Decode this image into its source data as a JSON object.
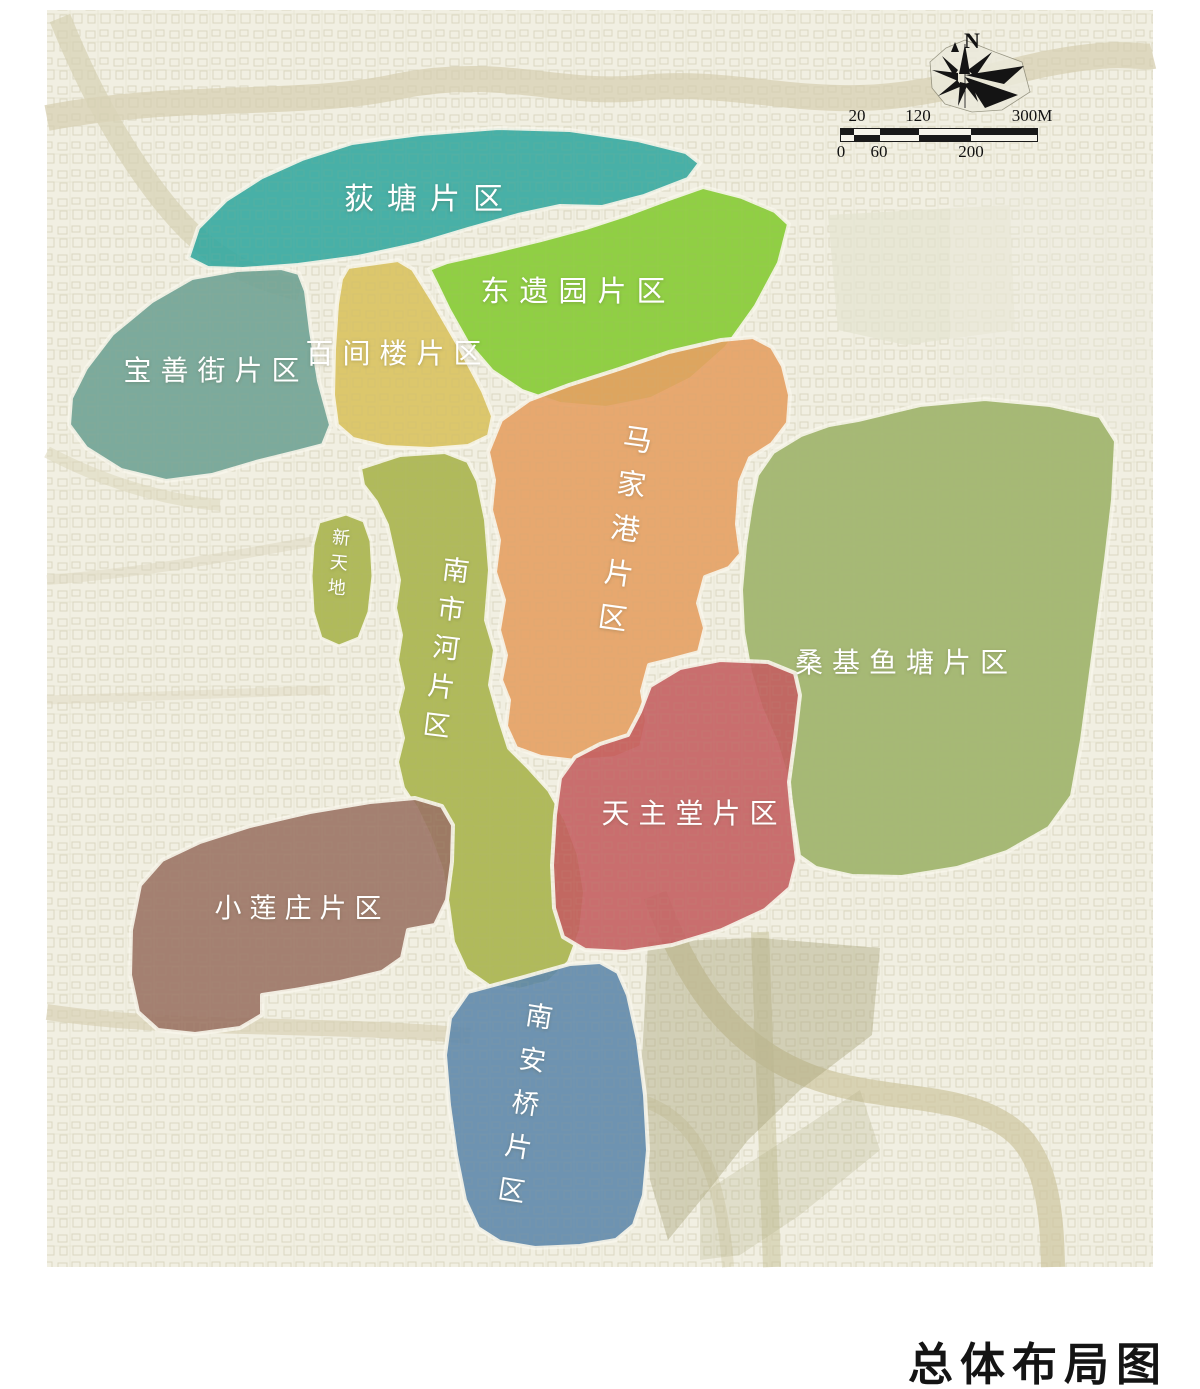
{
  "map": {
    "title": "总体布局图",
    "label_color": "#ffffff",
    "compass": {
      "north_label": "N"
    },
    "scale_bar": {
      "top_labels": [
        "20",
        "120",
        "300M"
      ],
      "bottom_labels": [
        "0",
        "60",
        "200"
      ]
    },
    "regions": [
      {
        "id": "ditang",
        "label": "荻塘片区",
        "color": "#35a8a1",
        "orientation": "horizontal"
      },
      {
        "id": "dongyiyuan",
        "label": "东遗园片区",
        "color": "#85cb33",
        "orientation": "horizontal"
      },
      {
        "id": "baoshanjie",
        "label": "宝善街片区",
        "color": "#6fa295",
        "orientation": "horizontal"
      },
      {
        "id": "baijianlou",
        "label": "百间楼片区",
        "color": "#d9c25f",
        "orientation": "horizontal"
      },
      {
        "id": "majiagang",
        "label": "马家港片区",
        "color": "#e5a063",
        "orientation": "vertical"
      },
      {
        "id": "sangjiyutang",
        "label": "桑基鱼塘片区",
        "color": "#9db269",
        "orientation": "horizontal"
      },
      {
        "id": "nanshihe",
        "label": "南市河片区",
        "color": "#a9b44c",
        "orientation": "vertical"
      },
      {
        "id": "xintiandi",
        "label": "新天地",
        "color": "#a9b44c",
        "orientation": "vertical"
      },
      {
        "id": "tianzhutang",
        "label": "天主堂片区",
        "color": "#c45f62",
        "orientation": "horizontal"
      },
      {
        "id": "xiaolianzhuang",
        "label": "小莲庄片区",
        "color": "#9b7365",
        "orientation": "horizontal"
      },
      {
        "id": "nananqiao",
        "label": "南安桥片区",
        "color": "#5f88ac",
        "orientation": "vertical"
      }
    ]
  }
}
